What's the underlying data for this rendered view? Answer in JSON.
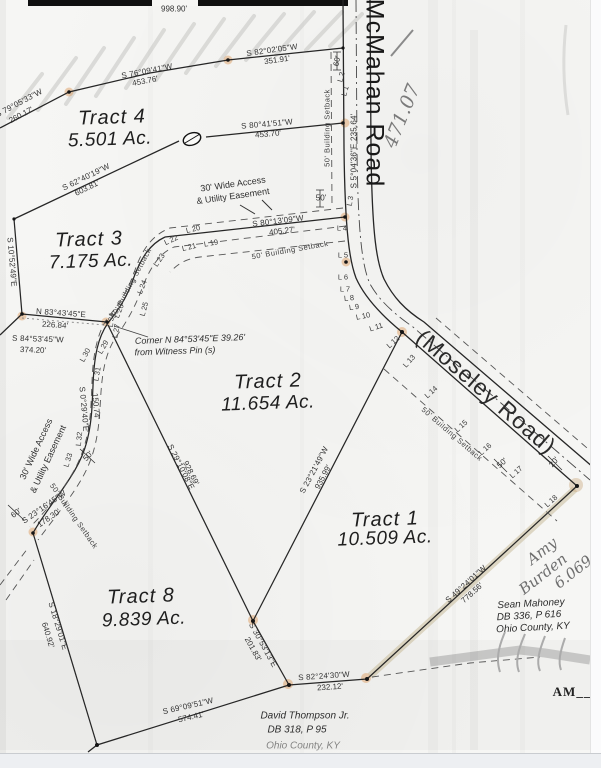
{
  "document": {
    "type": "scanned survey plat",
    "north_line_distance": "998.90'",
    "surveyor_initials": "AM__"
  },
  "tracts": [
    {
      "name": "Tract 4",
      "area": "5.501 Ac."
    },
    {
      "name": "Tract 3",
      "area": "7.175 Ac."
    },
    {
      "name": "Tract 2",
      "area": "11.654 Ac."
    },
    {
      "name": "Tract 1",
      "area": "10.509 Ac."
    },
    {
      "name": "Tract 8",
      "area": "9.839 Ac."
    }
  ],
  "roads": [
    "McMahan Road",
    "(Moseley Road)"
  ],
  "adjoiners": [
    {
      "lines": [
        "Sean Mahoney",
        "DB 336, P 616",
        "Ohio County, KY"
      ]
    },
    {
      "lines": [
        "David Thompson Jr.",
        "DB 318, P 95",
        "Ohio County, KY"
      ]
    }
  ],
  "handwritten": [
    "471.07",
    "Amy",
    "Burden",
    "6.069"
  ],
  "labels": [
    {
      "n": "dim-north-line",
      "t": "998.90'",
      "x": 174,
      "y": 9,
      "r": 0,
      "c": "ds"
    },
    {
      "n": "bearing",
      "t": "S 82°02'05\"W",
      "x": 272,
      "y": 50,
      "r": -8,
      "c": "br"
    },
    {
      "n": "distance",
      "t": "351.91'",
      "x": 277,
      "y": 60,
      "r": -8,
      "c": "ds"
    },
    {
      "n": "bearing",
      "t": "S 76°09'41\"W",
      "x": 147,
      "y": 71,
      "r": -11,
      "c": "br"
    },
    {
      "n": "distance",
      "t": "453.76'",
      "x": 145,
      "y": 81,
      "r": -11,
      "c": "ds"
    },
    {
      "n": "bearing",
      "t": "S 79°05'33\"W",
      "x": 19,
      "y": 103,
      "r": -28,
      "c": "br"
    },
    {
      "n": "distance",
      "t": "260.17'",
      "x": 21,
      "y": 115,
      "r": -28,
      "c": "ds"
    },
    {
      "n": "bearing",
      "t": "S 80°41'51\"W",
      "x": 267,
      "y": 124,
      "r": -5,
      "c": "br"
    },
    {
      "n": "distance",
      "t": "453.70'",
      "x": 268,
      "y": 134,
      "r": -5,
      "c": "ds"
    },
    {
      "n": "bearing",
      "t": "S 62°40'19\"W",
      "x": 86,
      "y": 177,
      "r": -26,
      "c": "br"
    },
    {
      "n": "distance",
      "t": "603.81'",
      "x": 87,
      "y": 188,
      "r": -26,
      "c": "ds"
    },
    {
      "n": "bearing",
      "t": "S 80°13'09\"W",
      "x": 278,
      "y": 221,
      "r": -7,
      "c": "br"
    },
    {
      "n": "distance",
      "t": "405.27'",
      "x": 282,
      "y": 231,
      "r": -7,
      "c": "ds"
    },
    {
      "n": "bearing",
      "t": "S 10°52'49\"E",
      "x": 12,
      "y": 262,
      "r": 85,
      "c": "br"
    },
    {
      "n": "bearing",
      "t": "N 83°43'45\"E",
      "x": 61,
      "y": 313,
      "r": 4,
      "c": "br"
    },
    {
      "n": "distance",
      "t": "226.84'",
      "x": 55,
      "y": 325,
      "r": 4,
      "c": "ds"
    },
    {
      "n": "bearing",
      "t": "S 84°53'45\"W",
      "x": 38,
      "y": 339,
      "r": 2,
      "c": "br"
    },
    {
      "n": "distance",
      "t": "374.20'",
      "x": 33,
      "y": 350,
      "r": 2,
      "c": "ds"
    },
    {
      "n": "bearing",
      "t": "S 0°29'40\"E",
      "x": 84,
      "y": 409,
      "r": 85,
      "c": "br"
    },
    {
      "n": "distance",
      "t": "150.74'",
      "x": 96,
      "y": 406,
      "r": 85,
      "c": "ds"
    },
    {
      "n": "bearing",
      "t": "S 5°04'36\"E  235.64'",
      "x": 354,
      "y": 151,
      "r": -90,
      "c": "br"
    },
    {
      "n": "bearing",
      "t": "S 23°16'45\"W",
      "x": 44,
      "y": 507,
      "r": -35,
      "c": "br"
    },
    {
      "n": "distance",
      "t": "178.30'",
      "x": 49,
      "y": 518,
      "r": -35,
      "c": "ds"
    },
    {
      "n": "bearing",
      "t": "S 18°29'01\"E",
      "x": 58,
      "y": 626,
      "r": 73,
      "c": "br"
    },
    {
      "n": "distance",
      "t": "640.92'",
      "x": 48,
      "y": 635,
      "r": 73,
      "c": "ds"
    },
    {
      "n": "bearing",
      "t": "S 29°10'08\"E",
      "x": 181,
      "y": 467,
      "r": 63,
      "c": "br"
    },
    {
      "n": "distance",
      "t": "928.69'",
      "x": 191,
      "y": 473,
      "r": 63,
      "c": "ds"
    },
    {
      "n": "bearing",
      "t": "S 23°21'49\"W",
      "x": 314,
      "y": 470,
      "r": -62,
      "c": "br"
    },
    {
      "n": "distance",
      "t": "935.99'",
      "x": 323,
      "y": 477,
      "r": -62,
      "c": "ds"
    },
    {
      "n": "bearing",
      "t": "S 30°53'13\"E",
      "x": 263,
      "y": 645,
      "r": 61,
      "c": "br"
    },
    {
      "n": "distance",
      "t": "201.83'",
      "x": 253,
      "y": 649,
      "r": 61,
      "c": "ds"
    },
    {
      "n": "bearing",
      "t": "S 82°24'30\"W",
      "x": 324,
      "y": 676,
      "r": -4,
      "c": "br"
    },
    {
      "n": "distance",
      "t": "232.12'",
      "x": 330,
      "y": 687,
      "r": -4,
      "c": "ds"
    },
    {
      "n": "bearing",
      "t": "S 69°09'51\"W",
      "x": 188,
      "y": 706,
      "r": -13,
      "c": "br"
    },
    {
      "n": "distance",
      "t": "574.41'",
      "x": 191,
      "y": 717,
      "r": -13,
      "c": "ds"
    },
    {
      "n": "bearing",
      "t": "S 49°24'01\"W",
      "x": 466,
      "y": 584,
      "r": -42,
      "c": "br"
    },
    {
      "n": "distance",
      "t": "778.56'",
      "x": 472,
      "y": 593,
      "r": -42,
      "c": "ds"
    },
    {
      "n": "dim",
      "t": "60'",
      "x": 337,
      "y": 61,
      "r": -78,
      "c": "dm"
    },
    {
      "n": "dim",
      "t": "50'",
      "x": 321,
      "y": 198,
      "r": 0,
      "c": "dm"
    },
    {
      "n": "dim",
      "t": "50'",
      "x": 88,
      "y": 456,
      "r": -48,
      "c": "dm"
    },
    {
      "n": "dim",
      "t": "60'",
      "x": 16,
      "y": 513,
      "r": -36,
      "c": "dm"
    },
    {
      "n": "dim",
      "t": "50'",
      "x": 502,
      "y": 463,
      "r": -42,
      "c": "dm"
    },
    {
      "n": "dim",
      "t": "20'",
      "x": 554,
      "y": 462,
      "r": -50,
      "c": "dm"
    },
    {
      "n": "line-label",
      "t": "L 1",
      "x": 345,
      "y": 91,
      "r": -75,
      "c": "lg"
    },
    {
      "n": "line-label",
      "t": "L 2",
      "x": 341,
      "y": 77,
      "r": -75,
      "c": "lg"
    },
    {
      "n": "line-label",
      "t": "L 3",
      "x": 350,
      "y": 201,
      "r": -80,
      "c": "lg"
    },
    {
      "n": "line-label",
      "t": "L 4",
      "x": 342,
      "y": 228,
      "r": 0,
      "c": "lg"
    },
    {
      "n": "line-label",
      "t": "L 5",
      "x": 343,
      "y": 255,
      "r": 0,
      "c": "lg"
    },
    {
      "n": "line-label",
      "t": "L 6",
      "x": 343,
      "y": 277,
      "r": 0,
      "c": "lg"
    },
    {
      "n": "line-label",
      "t": "L 7",
      "x": 345,
      "y": 289,
      "r": 0,
      "c": "lg"
    },
    {
      "n": "line-label",
      "t": "L 8",
      "x": 349,
      "y": 298,
      "r": -6,
      "c": "lg"
    },
    {
      "n": "line-label",
      "t": "L 9",
      "x": 354,
      "y": 307,
      "r": -8,
      "c": "lg"
    },
    {
      "n": "line-label",
      "t": "L 10",
      "x": 363,
      "y": 316,
      "r": -12,
      "c": "lg"
    },
    {
      "n": "line-label",
      "t": "L 11",
      "x": 376,
      "y": 327,
      "r": -18,
      "c": "lg"
    },
    {
      "n": "line-label",
      "t": "L 12",
      "x": 393,
      "y": 342,
      "r": -42,
      "c": "lg"
    },
    {
      "n": "line-label",
      "t": "L 13",
      "x": 409,
      "y": 361,
      "r": -48,
      "c": "lg"
    },
    {
      "n": "line-label",
      "t": "L 14",
      "x": 431,
      "y": 392,
      "r": -42,
      "c": "lg"
    },
    {
      "n": "line-label",
      "t": "L 15",
      "x": 461,
      "y": 426,
      "r": -42,
      "c": "lg"
    },
    {
      "n": "line-label",
      "t": "L 16",
      "x": 485,
      "y": 449,
      "r": -42,
      "c": "lg"
    },
    {
      "n": "line-label",
      "t": "L 17",
      "x": 516,
      "y": 472,
      "r": -42,
      "c": "lg"
    },
    {
      "n": "line-label",
      "t": "L 18",
      "x": 551,
      "y": 501,
      "r": -42,
      "c": "lg"
    },
    {
      "n": "line-label",
      "t": "L 19",
      "x": 211,
      "y": 243,
      "r": -10,
      "c": "lg"
    },
    {
      "n": "line-label",
      "t": "L 20",
      "x": 193,
      "y": 229,
      "r": -14,
      "c": "lg"
    },
    {
      "n": "line-label",
      "t": "L 21",
      "x": 189,
      "y": 247,
      "r": -14,
      "c": "lg"
    },
    {
      "n": "line-label",
      "t": "L 22",
      "x": 171,
      "y": 240,
      "r": -25,
      "c": "lg"
    },
    {
      "n": "line-label",
      "t": "L 23",
      "x": 159,
      "y": 260,
      "r": -55,
      "c": "lg"
    },
    {
      "n": "line-label",
      "t": "L 24",
      "x": 142,
      "y": 287,
      "r": -68,
      "c": "lg"
    },
    {
      "n": "line-label",
      "t": "L 25",
      "x": 144,
      "y": 309,
      "r": -75,
      "c": "lg"
    },
    {
      "n": "line-label",
      "t": "L 26",
      "x": 119,
      "y": 311,
      "r": -68,
      "c": "lg"
    },
    {
      "n": "line-label",
      "t": "L 27",
      "x": 116,
      "y": 331,
      "r": -80,
      "c": "lg"
    },
    {
      "n": "line-label",
      "t": "L 29",
      "x": 103,
      "y": 347,
      "r": -60,
      "c": "lg"
    },
    {
      "n": "line-label",
      "t": "L 30",
      "x": 85,
      "y": 355,
      "r": -62,
      "c": "lg"
    },
    {
      "n": "line-label",
      "t": "L 31",
      "x": 97,
      "y": 374,
      "r": -80,
      "c": "lg"
    },
    {
      "n": "line-label",
      "t": "L 32",
      "x": 79,
      "y": 439,
      "r": -84,
      "c": "lg"
    },
    {
      "n": "line-label",
      "t": "L 33",
      "x": 68,
      "y": 460,
      "r": -73,
      "c": "lg"
    },
    {
      "n": "line-label",
      "t": "L 34",
      "x": 111,
      "y": 320,
      "r": -85,
      "c": "lg"
    },
    {
      "n": "setback-label",
      "t": "50' Building Setback",
      "x": 327,
      "y": 128,
      "r": -90,
      "c": "sb"
    },
    {
      "n": "setback-label",
      "t": "50' Building Setback",
      "x": 290,
      "y": 250,
      "r": -10,
      "c": "sb"
    },
    {
      "n": "setback-label",
      "t": "50' Building Setback",
      "x": 131,
      "y": 283,
      "r": -62,
      "c": "sb"
    },
    {
      "n": "setback-label",
      "t": "50' Building Setback",
      "x": 74,
      "y": 516,
      "r": 55,
      "c": "sb"
    },
    {
      "n": "setback-label",
      "t": "50' Building Setback",
      "x": 452,
      "y": 434,
      "r": 41,
      "c": "sb"
    },
    {
      "n": "easement-label",
      "t": "30' Wide Access",
      "x": 233,
      "y": 184,
      "r": -8,
      "c": "es"
    },
    {
      "n": "easement-label",
      "t": "& Utility Easement",
      "x": 233,
      "y": 196,
      "r": -8,
      "c": "es"
    },
    {
      "n": "easement-label",
      "t": "30' Wide Access",
      "x": 36,
      "y": 449,
      "r": -65,
      "c": "es"
    },
    {
      "n": "easement-label",
      "t": "& Utility Easement",
      "x": 48,
      "y": 459,
      "r": -65,
      "c": "es"
    },
    {
      "n": "tract-name",
      "t": "Tract 4",
      "x": 112,
      "y": 118,
      "r": -2,
      "c": "tn"
    },
    {
      "n": "tract-area",
      "t": "5.501 Ac.",
      "x": 110,
      "y": 140,
      "r": -2,
      "c": "ta"
    },
    {
      "n": "tract-name",
      "t": "Tract 3",
      "x": 89,
      "y": 240,
      "r": -2,
      "c": "tn"
    },
    {
      "n": "tract-area",
      "t": "7.175 Ac.",
      "x": 91,
      "y": 262,
      "r": -2,
      "c": "ta"
    },
    {
      "n": "tract-name",
      "t": "Tract 2",
      "x": 268,
      "y": 382,
      "r": -2,
      "c": "tn"
    },
    {
      "n": "tract-area",
      "t": "11.654 Ac.",
      "x": 268,
      "y": 404,
      "r": -2,
      "c": "ta"
    },
    {
      "n": "tract-name",
      "t": "Tract 1",
      "x": 385,
      "y": 520,
      "r": -2,
      "c": "tn"
    },
    {
      "n": "tract-area",
      "t": "10.509 Ac.",
      "x": 385,
      "y": 539,
      "r": -2,
      "c": "ta"
    },
    {
      "n": "tract-name",
      "t": "Tract 8",
      "x": 141,
      "y": 597,
      "r": -2,
      "c": "tn"
    },
    {
      "n": "tract-area",
      "t": "9.839 Ac.",
      "x": 144,
      "y": 620,
      "r": -2,
      "c": "ta"
    },
    {
      "n": "road-name",
      "t": "McMahan Road",
      "x": 374,
      "y": 93,
      "r": 90,
      "c": "rd"
    },
    {
      "n": "road-name",
      "t": "(Moseley Road)",
      "x": 486,
      "y": 392,
      "r": 41,
      "c": "rd2"
    },
    {
      "n": "corner-note",
      "t": "Corner N 84°53'45\"E  39.26'",
      "x": 190,
      "y": 339,
      "r": -2,
      "c": "nt"
    },
    {
      "n": "corner-note",
      "t": "from Witness Pin (s)",
      "x": 175,
      "y": 351,
      "r": -2,
      "c": "nt"
    },
    {
      "n": "adjoiner-owner",
      "t": "Sean Mahoney",
      "x": 531,
      "y": 604,
      "r": -3,
      "c": "ow"
    },
    {
      "n": "adjoiner-deed",
      "t": "DB 336, P 616",
      "x": 529,
      "y": 616,
      "r": -3,
      "c": "ow"
    },
    {
      "n": "adjoiner-county",
      "t": "Ohio County, KY",
      "x": 533,
      "y": 628,
      "r": -3,
      "c": "ow"
    },
    {
      "n": "adjoiner-owner",
      "t": "David Thompson Jr.",
      "x": 305,
      "y": 716,
      "r": 0,
      "c": "ow"
    },
    {
      "n": "adjoiner-deed",
      "t": "DB 318, P 95",
      "x": 297,
      "y": 730,
      "r": 0,
      "c": "ow"
    },
    {
      "n": "adjoiner-county",
      "t": "Ohio County, KY",
      "x": 303,
      "y": 746,
      "r": 0,
      "c": "ow cut"
    },
    {
      "n": "handwritten-note",
      "t": "471.07",
      "x": 402,
      "y": 116,
      "r": -68,
      "c": "hwb"
    },
    {
      "n": "handwritten-note",
      "t": "Amy",
      "x": 542,
      "y": 551,
      "r": -38,
      "c": "hw"
    },
    {
      "n": "handwritten-note",
      "t": "Burden",
      "x": 543,
      "y": 574,
      "r": -38,
      "c": "hw"
    },
    {
      "n": "handwritten-note",
      "t": "6.069",
      "x": 573,
      "y": 572,
      "r": -38,
      "c": "hw"
    },
    {
      "n": "initials",
      "t": "AM__",
      "x": 572,
      "y": 692,
      "r": 0,
      "c": "ini"
    }
  ]
}
